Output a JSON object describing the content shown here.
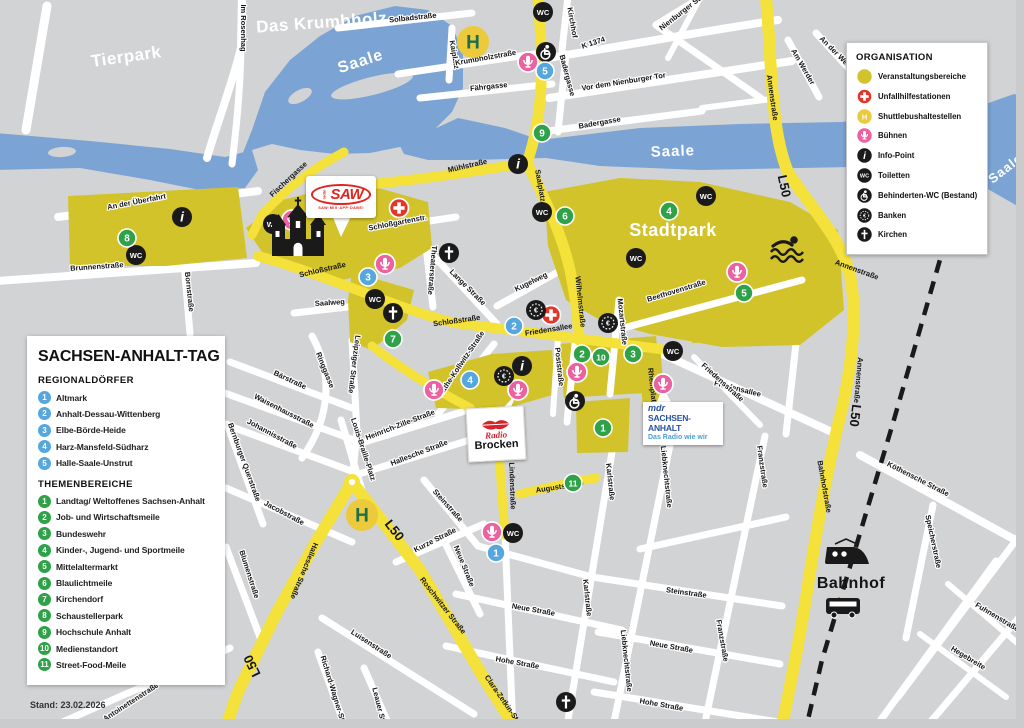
{
  "panel": {
    "title": "SACHSEN-ANHALT-TAG",
    "stand": "Stand: 23.02.2026",
    "sections": [
      {
        "heading": "REGIONALDÖRFER",
        "items": [
          {
            "n": "1",
            "label": "Altmark"
          },
          {
            "n": "2",
            "label": "Anhalt-Dessau-Wittenberg"
          },
          {
            "n": "3",
            "label": "Elbe-Börde-Heide"
          },
          {
            "n": "4",
            "label": "Harz-Mansfeld-Südharz"
          },
          {
            "n": "5",
            "label": "Halle-Saale-Unstrut"
          }
        ]
      },
      {
        "heading": "THEMENBEREICHE",
        "items": [
          {
            "n": "1",
            "label": "Landtag/ Weltoffenes Sachsen-Anhalt"
          },
          {
            "n": "2",
            "label": "Job- und Wirtschaftsmeile"
          },
          {
            "n": "3",
            "label": "Bundeswehr"
          },
          {
            "n": "4",
            "label": "Kinder-, Jugend- und Sportmeile"
          },
          {
            "n": "5",
            "label": "Mittelaltermarkt"
          },
          {
            "n": "6",
            "label": "Blaulichtmeile"
          },
          {
            "n": "7",
            "label": "Kirchendorf"
          },
          {
            "n": "8",
            "label": "Schaustellerpark"
          },
          {
            "n": "9",
            "label": "Hochschule Anhalt"
          },
          {
            "n": "10",
            "label": "Medienstandort"
          },
          {
            "n": "11",
            "label": "Street-Food-Meile"
          }
        ]
      }
    ]
  },
  "legend": {
    "title": "ORGANISATION",
    "items": [
      {
        "icon": "area-swatch",
        "label": "Veranstaltungsbereiche"
      },
      {
        "icon": "first-aid",
        "label": "Unfallhilfestationen"
      },
      {
        "icon": "shuttle-stop",
        "label": "Shuttlebushaltestellen"
      },
      {
        "icon": "stage",
        "label": "Bühnen"
      },
      {
        "icon": "info-point",
        "label": "Info-Point"
      },
      {
        "icon": "wc",
        "label": "Toiletten"
      },
      {
        "icon": "accessible-wc",
        "label": "Behinderten-WC (Bestand)"
      },
      {
        "icon": "bank",
        "label": "Banken"
      },
      {
        "icon": "church",
        "label": "Kirchen"
      }
    ]
  },
  "glyphs": {
    "wc": "WC",
    "shuttle": "H",
    "info": "i",
    "bank": "€"
  },
  "colors": {
    "background": "#d2d3d5",
    "event_area": "#d3c32b",
    "main_road": "#f4e13a",
    "river": "#7ba4d4",
    "stage_pink": "#ec619f",
    "aid_red": "#e2352b",
    "regional_blue": "#55a7dd",
    "theme_green": "#2fa148",
    "shuttle_yellow": "#edc93c",
    "shuttle_h_green": "#1b6e4e",
    "marker_black": "#1a1a1a"
  },
  "map": {
    "area_labels": [
      {
        "t": "Tierpark",
        "x": 127,
        "y": 62,
        "r": -8,
        "s": 17
      },
      {
        "t": "Das Krumbholz",
        "x": 322,
        "y": 28,
        "r": -4,
        "s": 17
      },
      {
        "t": "Stadtpark",
        "x": 673,
        "y": 236,
        "r": 0,
        "s": 18
      },
      {
        "t": "Bahnhof",
        "x": 851,
        "y": 588,
        "r": 0,
        "s": 16,
        "c": "dark"
      }
    ],
    "river_labels": [
      {
        "t": "Saale",
        "x": 362,
        "y": 66,
        "r": -18,
        "s": 16
      },
      {
        "t": "Saale",
        "x": 673,
        "y": 156,
        "r": -2,
        "s": 15
      },
      {
        "t": "Saale",
        "x": 1008,
        "y": 172,
        "r": -38,
        "s": 13
      }
    ],
    "road_labels": [
      {
        "t": "L50",
        "x": 780,
        "y": 187,
        "r": 78
      },
      {
        "t": "L50",
        "x": 851,
        "y": 415,
        "r": 97
      },
      {
        "t": "L50",
        "x": 391,
        "y": 533,
        "r": 52
      },
      {
        "t": "L50",
        "x": 256,
        "y": 664,
        "r": -116
      }
    ],
    "street_labels": [
      {
        "t": "Im Rosenhag",
        "x": 241,
        "y": 28,
        "r": 90
      },
      {
        "t": "Solbadstraße",
        "x": 413,
        "y": 20,
        "r": -6
      },
      {
        "t": "Kaiplatz",
        "x": 452,
        "y": 55,
        "r": 80
      },
      {
        "t": "Krumbholzstraße",
        "x": 486,
        "y": 60,
        "r": -10
      },
      {
        "t": "Kirchhof",
        "x": 570,
        "y": 23,
        "r": 80
      },
      {
        "t": "K 1374",
        "x": 594,
        "y": 45,
        "r": -18
      },
      {
        "t": "Vor dem Nienburger Tor",
        "x": 624,
        "y": 84,
        "r": -9
      },
      {
        "t": "Fährgasse",
        "x": 489,
        "y": 89,
        "r": -6
      },
      {
        "t": "Badergasse",
        "x": 565,
        "y": 76,
        "r": 75
      },
      {
        "t": "Badergasse",
        "x": 600,
        "y": 125,
        "r": -10
      },
      {
        "t": "Nienburger Str.",
        "x": 683,
        "y": 14,
        "r": -38
      },
      {
        "t": "Am Werder",
        "x": 801,
        "y": 68,
        "r": 60
      },
      {
        "t": "An der Weide",
        "x": 836,
        "y": 56,
        "r": 45
      },
      {
        "t": "Annenstraße",
        "x": 770,
        "y": 98,
        "r": 82,
        "oy": 1
      },
      {
        "t": "Annenstraße",
        "x": 856,
        "y": 272,
        "r": 20,
        "oy": 1
      },
      {
        "t": "Annenstraße",
        "x": 856,
        "y": 380,
        "r": 95,
        "oy": 1
      },
      {
        "t": "Mühlstraße",
        "x": 468,
        "y": 168,
        "r": -13,
        "oy": 1
      },
      {
        "t": "Fischergasse",
        "x": 290,
        "y": 181,
        "r": -43,
        "oy": 1
      },
      {
        "t": "An der Überfahrt",
        "x": 137,
        "y": 204,
        "r": -11
      },
      {
        "t": "Brunnenstraße",
        "x": 97,
        "y": 269,
        "r": -4
      },
      {
        "t": "Bornstraße",
        "x": 187,
        "y": 292,
        "r": 84
      },
      {
        "t": "Schloßgartenstr.",
        "x": 398,
        "y": 225,
        "r": -11
      },
      {
        "t": "Theaterstraße",
        "x": 430,
        "y": 270,
        "r": 95
      },
      {
        "t": "Schloßstraße",
        "x": 323,
        "y": 272,
        "r": -13,
        "oy": 1
      },
      {
        "t": "Schloßstraße",
        "x": 457,
        "y": 323,
        "r": -8,
        "oy": 1
      },
      {
        "t": "Saalweg",
        "x": 330,
        "y": 305,
        "r": -4
      },
      {
        "t": "Lange Straße",
        "x": 466,
        "y": 289,
        "r": 45
      },
      {
        "t": "Kugelweg",
        "x": 532,
        "y": 284,
        "r": -26
      },
      {
        "t": "Saalplatz",
        "x": 538,
        "y": 186,
        "r": 80,
        "oy": 1
      },
      {
        "t": "Wilhelmstraße",
        "x": 578,
        "y": 302,
        "r": 84,
        "oy": 1
      },
      {
        "t": "Friedensallee",
        "x": 549,
        "y": 332,
        "r": -9,
        "oy": 1
      },
      {
        "t": "Friedensallee",
        "x": 737,
        "y": 391,
        "r": 14
      },
      {
        "t": "Poststraße",
        "x": 557,
        "y": 367,
        "r": 84
      },
      {
        "t": "Mozartstraße",
        "x": 620,
        "y": 322,
        "r": 84
      },
      {
        "t": "Beethovenstraße",
        "x": 677,
        "y": 293,
        "r": -17
      },
      {
        "t": "Käthe-Kollwitz-Straße",
        "x": 463,
        "y": 365,
        "r": -56
      },
      {
        "t": "Leipziger Straße",
        "x": 352,
        "y": 364,
        "r": 97
      },
      {
        "t": "Ringgasse",
        "x": 323,
        "y": 371,
        "r": 68
      },
      {
        "t": "Bärstraße",
        "x": 289,
        "y": 382,
        "r": 25
      },
      {
        "t": "Waisenhausstraße",
        "x": 283,
        "y": 413,
        "r": 27
      },
      {
        "t": "Johannisstraße",
        "x": 271,
        "y": 436,
        "r": 28
      },
      {
        "t": "Bernburger Querstraße",
        "x": 242,
        "y": 463,
        "r": 70
      },
      {
        "t": "Jacobstraße",
        "x": 283,
        "y": 515,
        "r": 28
      },
      {
        "t": "Blumenstraße",
        "x": 247,
        "y": 575,
        "r": 72
      },
      {
        "t": "Louis-Braille-Platz",
        "x": 361,
        "y": 450,
        "r": 72
      },
      {
        "t": "Heinrich-Zille-Straße",
        "x": 401,
        "y": 427,
        "r": -21
      },
      {
        "t": "Hallesche Straße",
        "x": 420,
        "y": 455,
        "r": -21
      },
      {
        "t": "Hallesche Straße",
        "x": 302,
        "y": 570,
        "r": 113,
        "oy": 1
      },
      {
        "t": "Steinstraße",
        "x": 446,
        "y": 507,
        "r": 48
      },
      {
        "t": "Kurze Straße",
        "x": 436,
        "y": 542,
        "r": -27
      },
      {
        "t": "Neue Straße",
        "x": 462,
        "y": 567,
        "r": 68
      },
      {
        "t": "Lindenstraße",
        "x": 510,
        "y": 486,
        "r": 88,
        "oy": 1
      },
      {
        "t": "Auguststraße",
        "x": 560,
        "y": 489,
        "r": -9,
        "oy": 1
      },
      {
        "t": "Karlstraße",
        "x": 608,
        "y": 482,
        "r": 84
      },
      {
        "t": "Karlstraße",
        "x": 585,
        "y": 598,
        "r": 84
      },
      {
        "t": "Rheinplatz",
        "x": 650,
        "y": 387,
        "r": 84,
        "oy": 1
      },
      {
        "t": "Liebknechtstraße",
        "x": 664,
        "y": 477,
        "r": 84
      },
      {
        "t": "Liebknechtstraße",
        "x": 624,
        "y": 661,
        "r": 84
      },
      {
        "t": "Friedensstraße",
        "x": 721,
        "y": 384,
        "r": 42
      },
      {
        "t": "Steinstraße",
        "x": 686,
        "y": 595,
        "r": 8
      },
      {
        "t": "Neue Straße",
        "x": 533,
        "y": 612,
        "r": 10
      },
      {
        "t": "Neue Straße",
        "x": 671,
        "y": 649,
        "r": 10
      },
      {
        "t": "Hohe Straße",
        "x": 517,
        "y": 665,
        "r": 10
      },
      {
        "t": "Hohe Straße",
        "x": 661,
        "y": 707,
        "r": 10
      },
      {
        "t": "Franzstraße",
        "x": 760,
        "y": 467,
        "r": 82
      },
      {
        "t": "Franzstraße",
        "x": 720,
        "y": 641,
        "r": 80
      },
      {
        "t": "Roschwitzer Straße",
        "x": 441,
        "y": 607,
        "r": 52,
        "oy": 1
      },
      {
        "t": "Clara-Zetkin-Str.",
        "x": 501,
        "y": 701,
        "r": 55,
        "oy": 1
      },
      {
        "t": "Bahnhofstraße",
        "x": 822,
        "y": 487,
        "r": 80,
        "oy": 1
      },
      {
        "t": "Köthensche Straße",
        "x": 917,
        "y": 481,
        "r": 27
      },
      {
        "t": "Speicherstraße",
        "x": 931,
        "y": 542,
        "r": 78
      },
      {
        "t": "Fuhnenstraße",
        "x": 996,
        "y": 619,
        "r": 31
      },
      {
        "t": "Hegebreite",
        "x": 967,
        "y": 660,
        "r": 31
      },
      {
        "t": "Luisenstraße",
        "x": 370,
        "y": 646,
        "r": 33
      },
      {
        "t": "Richard-Wagner-Str.",
        "x": 331,
        "y": 691,
        "r": 73
      },
      {
        "t": "Leauer Str.",
        "x": 377,
        "y": 707,
        "r": 76
      },
      {
        "t": "Antoinettenstraße",
        "x": 132,
        "y": 704,
        "r": -33
      }
    ],
    "markers": [
      {
        "t": "wc",
        "x": 543,
        "y": 12
      },
      {
        "t": "wc",
        "x": 136,
        "y": 255
      },
      {
        "t": "wc",
        "x": 273,
        "y": 224
      },
      {
        "t": "wc",
        "x": 375,
        "y": 299
      },
      {
        "t": "wc",
        "x": 542,
        "y": 212
      },
      {
        "t": "wc",
        "x": 636,
        "y": 258
      },
      {
        "t": "wc",
        "x": 706,
        "y": 196
      },
      {
        "t": "wc",
        "x": 673,
        "y": 351
      },
      {
        "t": "wc",
        "x": 513,
        "y": 533
      },
      {
        "t": "wheelchair",
        "x": 546,
        "y": 52
      },
      {
        "t": "wheelchair",
        "x": 575,
        "y": 401
      },
      {
        "t": "aid",
        "x": 399,
        "y": 208
      },
      {
        "t": "aid",
        "x": 551,
        "y": 315
      },
      {
        "t": "stage",
        "x": 528,
        "y": 62
      },
      {
        "t": "stage",
        "x": 292,
        "y": 220
      },
      {
        "t": "stage",
        "x": 385,
        "y": 264
      },
      {
        "t": "stage",
        "x": 434,
        "y": 390
      },
      {
        "t": "stage",
        "x": 518,
        "y": 390
      },
      {
        "t": "stage",
        "x": 577,
        "y": 372
      },
      {
        "t": "stage",
        "x": 663,
        "y": 384
      },
      {
        "t": "stage",
        "x": 737,
        "y": 272
      },
      {
        "t": "stage",
        "x": 492,
        "y": 532
      },
      {
        "t": "info",
        "x": 182,
        "y": 217
      },
      {
        "t": "info",
        "x": 518,
        "y": 164
      },
      {
        "t": "info",
        "x": 522,
        "y": 366
      },
      {
        "t": "bank",
        "x": 536,
        "y": 310
      },
      {
        "t": "bank",
        "x": 608,
        "y": 323
      },
      {
        "t": "bank",
        "x": 504,
        "y": 376
      },
      {
        "t": "church",
        "x": 449,
        "y": 253
      },
      {
        "t": "church",
        "x": 393,
        "y": 313
      },
      {
        "t": "church",
        "x": 566,
        "y": 702
      },
      {
        "t": "shuttle",
        "x": 473,
        "y": 42
      },
      {
        "t": "shuttle",
        "x": 362,
        "y": 515
      },
      {
        "t": "junction",
        "x": 352,
        "y": 482
      },
      {
        "t": "regional",
        "x": 496,
        "y": 553,
        "n": "1"
      },
      {
        "t": "regional",
        "x": 514,
        "y": 326,
        "n": "2"
      },
      {
        "t": "regional",
        "x": 368,
        "y": 277,
        "n": "3"
      },
      {
        "t": "regional",
        "x": 470,
        "y": 380,
        "n": "4"
      },
      {
        "t": "regional",
        "x": 545,
        "y": 71,
        "n": "5"
      },
      {
        "t": "theme",
        "x": 603,
        "y": 428,
        "n": "1"
      },
      {
        "t": "theme",
        "x": 582,
        "y": 354,
        "n": "2"
      },
      {
        "t": "theme",
        "x": 633,
        "y": 354,
        "n": "3"
      },
      {
        "t": "theme",
        "x": 669,
        "y": 211,
        "n": "4"
      },
      {
        "t": "theme",
        "x": 744,
        "y": 293,
        "n": "5"
      },
      {
        "t": "theme",
        "x": 565,
        "y": 216,
        "n": "6"
      },
      {
        "t": "theme",
        "x": 393,
        "y": 339,
        "n": "7"
      },
      {
        "t": "theme",
        "x": 127,
        "y": 238,
        "n": "8"
      },
      {
        "t": "theme",
        "x": 542,
        "y": 133,
        "n": "9"
      },
      {
        "t": "theme",
        "x": 601,
        "y": 357,
        "n": "10"
      },
      {
        "t": "theme",
        "x": 573,
        "y": 483,
        "n": "11"
      },
      {
        "t": "castle",
        "x": 298,
        "y": 242
      },
      {
        "t": "swimmer",
        "x": 787,
        "y": 249
      },
      {
        "t": "train",
        "x": 848,
        "y": 556
      },
      {
        "t": "bus",
        "x": 843,
        "y": 607
      }
    ],
    "logos": {
      "saw": {
        "radio": "radio",
        "name": "SAW",
        "tagline": "SAW·MIX·APP·DABEI"
      },
      "brocken": {
        "radio": "Radio",
        "name": "Brocken"
      },
      "mdr": {
        "brand": "mdr",
        "region": "SACHSEN-ANHALT",
        "claim": "Das Radio wie wir"
      }
    }
  }
}
